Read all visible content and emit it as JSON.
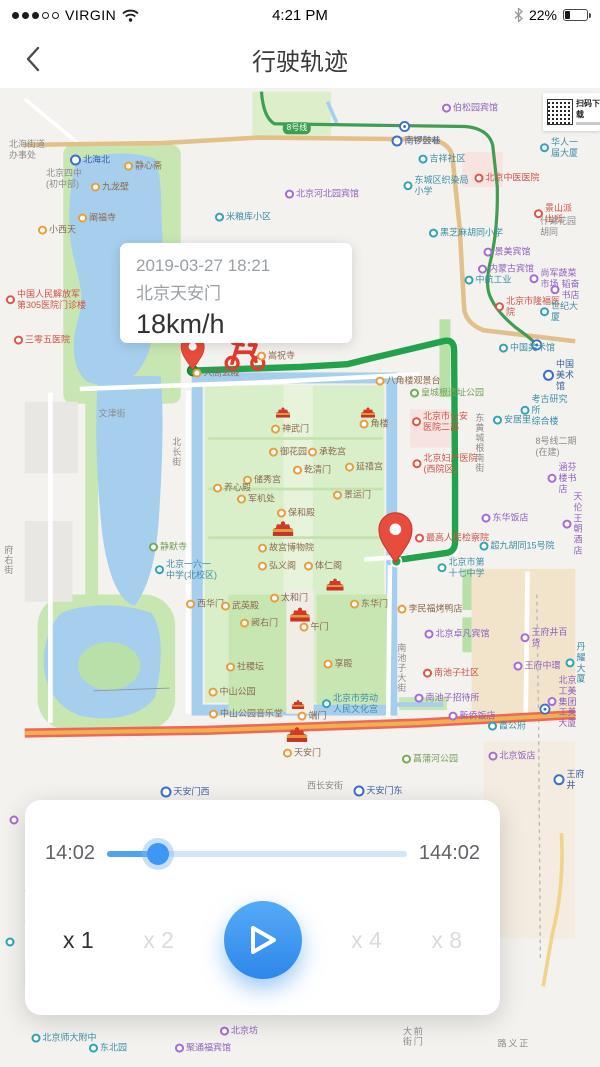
{
  "status": {
    "carrier": "VIRGIN",
    "time": "4:21 PM",
    "battery_pct": "22%"
  },
  "nav": {
    "title": "行驶轨迹"
  },
  "info_card": {
    "date": "2019-03-27  18:21",
    "place": "北京天安门",
    "speed": "18km/h"
  },
  "qr": {
    "label": "扫码下载"
  },
  "playback": {
    "current_time": "14:02",
    "total_time": "144:02",
    "progress_pct": 17,
    "speeds": [
      {
        "label": "x 1",
        "active": true
      },
      {
        "label": "x 2",
        "active": false
      },
      {
        "label": "x 4",
        "active": false
      },
      {
        "label": "x 8",
        "active": false
      }
    ]
  },
  "map": {
    "colors": {
      "route": "#23a24d",
      "water": "#a6cfee",
      "park": "#c8e6b2",
      "pin": "#e84c3d",
      "accent_blue": "#3e97f3"
    },
    "labels": [
      {
        "t": "北海街道\n办事处",
        "x": 27,
        "y": 150,
        "c": "gr"
      },
      {
        "t": "北海北",
        "x": 90,
        "y": 160,
        "c": "me"
      },
      {
        "t": "北京四中\n(初中部)",
        "x": 64,
        "y": 179,
        "c": "gr"
      },
      {
        "t": "静心斋",
        "x": 143,
        "y": 166,
        "c": "sc"
      },
      {
        "t": "九龙壁",
        "x": 110,
        "y": 187,
        "c": "sc"
      },
      {
        "t": "阐福寺",
        "x": 97,
        "y": 218,
        "c": "sc"
      },
      {
        "t": "小西天",
        "x": 57,
        "y": 230,
        "c": "sc"
      },
      {
        "t": "中国人民解放军\n第305医院门诊楼",
        "x": 46,
        "y": 300,
        "c": "hp"
      },
      {
        "t": "三零五医院",
        "x": 42,
        "y": 340,
        "c": "hp"
      },
      {
        "t": "文津街",
        "x": 112,
        "y": 414,
        "c": "rd"
      },
      {
        "t": "北长街",
        "x": 176,
        "y": 452,
        "c": "rd",
        "v": true
      },
      {
        "t": "府右街",
        "x": 8,
        "y": 560,
        "c": "rd",
        "v": true
      },
      {
        "t": "静默寺",
        "x": 168,
        "y": 547,
        "c": "pk"
      },
      {
        "t": "北京一六一\n中学(北校区)",
        "x": 186,
        "y": 570,
        "c": "bu"
      },
      {
        "t": "西华门",
        "x": 205,
        "y": 604,
        "c": "sc"
      },
      {
        "t": "米粮库小区",
        "x": 243,
        "y": 217,
        "c": "bu"
      },
      {
        "t": "大高玄殿",
        "x": 216,
        "y": 373,
        "c": "sc"
      },
      {
        "t": "嵩祝寺",
        "x": 276,
        "y": 356,
        "c": "sc"
      },
      {
        "t": "八角楼观景台",
        "x": 408,
        "y": 381,
        "c": "sc"
      },
      {
        "t": "皇城根遗址公园",
        "x": 447,
        "y": 393,
        "c": "pk"
      },
      {
        "t": "神武门",
        "x": 290,
        "y": 429,
        "c": "sc"
      },
      {
        "t": "角楼",
        "x": 374,
        "y": 424,
        "c": "sc"
      },
      {
        "t": "御花园",
        "x": 288,
        "y": 452,
        "c": "sc"
      },
      {
        "t": "承乾宫",
        "x": 327,
        "y": 452,
        "c": "sc"
      },
      {
        "t": "延禧宫",
        "x": 364,
        "y": 467,
        "c": "sc"
      },
      {
        "t": "储秀宫",
        "x": 262,
        "y": 480,
        "c": "sc"
      },
      {
        "t": "乾清门",
        "x": 312,
        "y": 470,
        "c": "sc"
      },
      {
        "t": "养心殿",
        "x": 232,
        "y": 488,
        "c": "sc"
      },
      {
        "t": "军机处",
        "x": 256,
        "y": 499,
        "c": "sc"
      },
      {
        "t": "保和殿",
        "x": 296,
        "y": 513,
        "c": "sc"
      },
      {
        "t": "景运门",
        "x": 352,
        "y": 495,
        "c": "sc"
      },
      {
        "t": "故宫博物院",
        "x": 286,
        "y": 548,
        "c": "sc"
      },
      {
        "t": "弘义阁",
        "x": 277,
        "y": 566,
        "c": "sc"
      },
      {
        "t": "体仁阁",
        "x": 323,
        "y": 566,
        "c": "sc"
      },
      {
        "t": "太和门",
        "x": 289,
        "y": 598,
        "c": "sc"
      },
      {
        "t": "武英殿",
        "x": 240,
        "y": 606,
        "c": "sc"
      },
      {
        "t": "东华门",
        "x": 369,
        "y": 604,
        "c": "sc"
      },
      {
        "t": "阙右门",
        "x": 259,
        "y": 623,
        "c": "sc"
      },
      {
        "t": "午门",
        "x": 314,
        "y": 627,
        "c": "sc"
      },
      {
        "t": "端门",
        "x": 312,
        "y": 716,
        "c": "sc"
      },
      {
        "t": "社稷坛",
        "x": 245,
        "y": 667,
        "c": "sc"
      },
      {
        "t": "中山公园",
        "x": 232,
        "y": 692,
        "c": "sc"
      },
      {
        "t": "中山公园音乐堂",
        "x": 246,
        "y": 714,
        "c": "sc"
      },
      {
        "t": "享殿",
        "x": 338,
        "y": 664,
        "c": "sc"
      },
      {
        "t": "北京市劳动\n人民文化宫",
        "x": 350,
        "y": 704,
        "c": "bu"
      },
      {
        "t": "菖蒲河公园",
        "x": 430,
        "y": 759,
        "c": "pk"
      },
      {
        "t": "天安门",
        "x": 302,
        "y": 753,
        "c": "sc"
      },
      {
        "t": "西长安街",
        "x": 325,
        "y": 786,
        "c": "rd"
      },
      {
        "t": "天安门西",
        "x": 185,
        "y": 792,
        "c": "me"
      },
      {
        "t": "天安门东",
        "x": 378,
        "y": 791,
        "c": "me"
      },
      {
        "t": "南锣鼓巷",
        "x": 416,
        "y": 141,
        "c": "me"
      },
      {
        "t": "8号线",
        "x": 297,
        "y": 128,
        "c": "b8"
      },
      {
        "t": "吉祥社区",
        "x": 442,
        "y": 159,
        "c": "bu"
      },
      {
        "t": "东城区织染局\n小学",
        "x": 436,
        "y": 186,
        "c": "bu"
      },
      {
        "t": "黑芝麻胡同小学",
        "x": 466,
        "y": 233,
        "c": "bu"
      },
      {
        "t": "伯松园宾馆",
        "x": 470,
        "y": 108,
        "c": "ho"
      },
      {
        "t": "华人一届大厦",
        "x": 560,
        "y": 148,
        "c": "bu"
      },
      {
        "t": "北京河北园宾馆",
        "x": 322,
        "y": 194,
        "c": "ho"
      },
      {
        "t": "北京中医医院",
        "x": 507,
        "y": 178,
        "c": "hp"
      },
      {
        "t": "景山派出所",
        "x": 556,
        "y": 214,
        "c": "hp"
      },
      {
        "t": "什锦花园胡同",
        "x": 560,
        "y": 227,
        "c": "gr"
      },
      {
        "t": "景美宾馆",
        "x": 507,
        "y": 252,
        "c": "ho"
      },
      {
        "t": "内蒙古宾馆",
        "x": 506,
        "y": 269,
        "c": "ho"
      },
      {
        "t": "中航工业",
        "x": 488,
        "y": 280,
        "c": "bu"
      },
      {
        "t": "尚军蔬菜市场",
        "x": 553,
        "y": 279,
        "c": "ho"
      },
      {
        "t": "韬奋书店",
        "x": 567,
        "y": 290,
        "c": "ho"
      },
      {
        "t": "北京市隆福医院",
        "x": 530,
        "y": 307,
        "c": "hp"
      },
      {
        "t": "世纪大厦",
        "x": 560,
        "y": 312,
        "c": "bu"
      },
      {
        "t": "中国美术馆",
        "x": 527,
        "y": 348,
        "c": "bu"
      },
      {
        "t": "中国美术馆",
        "x": 562,
        "y": 375,
        "c": "me"
      },
      {
        "t": "考古研究所\n综合楼",
        "x": 547,
        "y": 410,
        "c": "bu"
      },
      {
        "t": "安居里",
        "x": 512,
        "y": 420,
        "c": "bu"
      },
      {
        "t": "8号线二期\n(在建)",
        "x": 556,
        "y": 447,
        "c": "gr"
      },
      {
        "t": "北京市公安\n医院二部",
        "x": 440,
        "y": 422,
        "c": "hp"
      },
      {
        "t": "北京妇产医院\n(西院区)",
        "x": 445,
        "y": 464,
        "c": "hp"
      },
      {
        "t": "涵芬楼书店",
        "x": 565,
        "y": 478,
        "c": "ho"
      },
      {
        "t": "东华饭店",
        "x": 505,
        "y": 518,
        "c": "ho"
      },
      {
        "t": "天伦王朝酒店",
        "x": 575,
        "y": 524,
        "c": "ho"
      },
      {
        "t": "超九胡同15号院",
        "x": 517,
        "y": 546,
        "c": "bu"
      },
      {
        "t": "最高人民检察院",
        "x": 452,
        "y": 538,
        "c": "hp"
      },
      {
        "t": "北京市第\n十七中学",
        "x": 461,
        "y": 568,
        "c": "bu"
      },
      {
        "t": "李民福烤鸭店",
        "x": 430,
        "y": 609,
        "c": "sc"
      },
      {
        "t": "北京卓凡宾馆",
        "x": 457,
        "y": 634,
        "c": "ho"
      },
      {
        "t": "南池子社区",
        "x": 451,
        "y": 673,
        "c": "hp"
      },
      {
        "t": "南池子招待所",
        "x": 447,
        "y": 698,
        "c": "ho"
      },
      {
        "t": "新侨饭店",
        "x": 472,
        "y": 716,
        "c": "ho"
      },
      {
        "t": "霞公府",
        "x": 507,
        "y": 726,
        "c": "bu"
      },
      {
        "t": "北京饭店",
        "x": 512,
        "y": 756,
        "c": "ho"
      },
      {
        "t": "王府井百货",
        "x": 547,
        "y": 638,
        "c": "ho"
      },
      {
        "t": "王府中環",
        "x": 537,
        "y": 666,
        "c": "ho"
      },
      {
        "t": "丹耀大厦",
        "x": 577,
        "y": 663,
        "c": "bu"
      },
      {
        "t": "北京工美集团\n工美大厦",
        "x": 565,
        "y": 702,
        "c": "ho"
      },
      {
        "t": "王府井",
        "x": 569,
        "y": 780,
        "c": "me"
      },
      {
        "t": "南池子大街",
        "x": 401,
        "y": 668,
        "c": "rd",
        "v": true
      },
      {
        "t": "东黄城根南街",
        "x": 479,
        "y": 443,
        "c": "rd",
        "v": true
      },
      {
        "t": "前门大街",
        "x": 412,
        "y": 1040,
        "c": "rd",
        "v": true
      },
      {
        "t": "正义路",
        "x": 512,
        "y": 1048,
        "c": "rd",
        "v": true
      },
      {
        "t": "北京坊",
        "x": 239,
        "y": 1031,
        "c": "ho"
      },
      {
        "t": "聚通福宾馆",
        "x": 203,
        "y": 1048,
        "c": "ho"
      },
      {
        "t": "东北园",
        "x": 108,
        "y": 1048,
        "c": "bu"
      },
      {
        "t": "北京师大附中",
        "x": 64,
        "y": 1038,
        "c": "bu"
      }
    ],
    "landmarks": [
      {
        "x": 283,
        "y": 412,
        "s": 0.8
      },
      {
        "x": 368,
        "y": 412,
        "s": 0.8
      },
      {
        "x": 283,
        "y": 528,
        "s": 1.15
      },
      {
        "x": 335,
        "y": 584,
        "s": 0.95
      },
      {
        "x": 300,
        "y": 614,
        "s": 1.1
      },
      {
        "x": 298,
        "y": 704,
        "s": 0.7
      },
      {
        "x": 297,
        "y": 734,
        "s": 1.15
      }
    ],
    "icons_only": [
      {
        "x": 14,
        "y": 820,
        "c": "ho"
      },
      {
        "x": 10,
        "y": 942,
        "c": "bu"
      }
    ]
  }
}
